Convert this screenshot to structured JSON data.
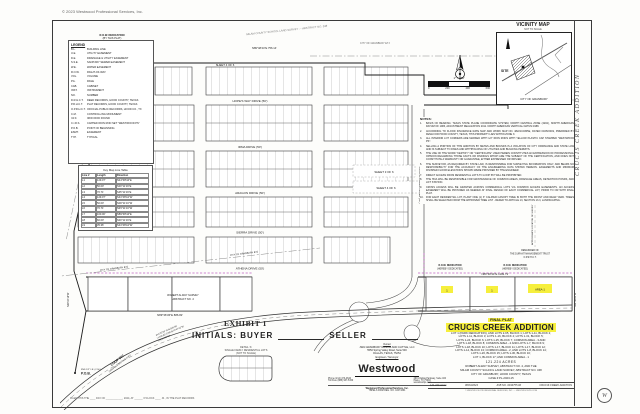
{
  "page": {
    "copyright": "© 2023 Westwood Professional Services, Inc.",
    "side_title": "CRUCIS CREEK ADDITION",
    "filing": "FILED THIS THE ____ DAY OF ____________, 2024, AT ______ O'CLOCK ____ .M., IN THE PLAT RECORDS"
  },
  "exhibit": {
    "label": "EXHIBIT 1",
    "initials": "INITIALS: BUYER",
    "seller": "SELLER"
  },
  "legend": {
    "title": "LEGEND",
    "items": [
      {
        "abbr": "B.L.",
        "desc": "BUILDING LINE"
      },
      {
        "abbr": "U.E.",
        "desc": "UTILITY EASEMENT"
      },
      {
        "abbr": "D.E.",
        "desc": "DRAINAGE & UTILITY EASEMENT"
      },
      {
        "abbr": "S.S.E.",
        "desc": "SANITARY SEWER EASEMENT"
      },
      {
        "abbr": "W.E.",
        "desc": "WATER EASEMENT"
      },
      {
        "abbr": "R.O.W.",
        "desc": "RIGHT-OF-WAY"
      },
      {
        "abbr": "VOL.",
        "desc": "VOLUME"
      },
      {
        "abbr": "PG.",
        "desc": "PAGE"
      },
      {
        "abbr": "CAB.",
        "desc": "CABINET"
      },
      {
        "abbr": "INST.",
        "desc": "INSTRUMENT"
      },
      {
        "abbr": "NO.",
        "desc": "NUMBER"
      },
      {
        "abbr": "D.R.H.C.T.",
        "desc": "DEED RECORDS, HOOD COUNTY, TEXAS"
      },
      {
        "abbr": "P.R.H.C.T.",
        "desc": "PLAT RECORDS, HOOD COUNTY, TEXAS"
      },
      {
        "abbr": "O.P.R.H.C.T.",
        "desc": "OFFICIAL PUBLIC RECORDS, HOOD CO., TX"
      },
      {
        "abbr": "C.M.",
        "desc": "CONTROLLING MONUMENT"
      },
      {
        "abbr": "I.R.F.",
        "desc": "IRON ROD FOUND"
      },
      {
        "abbr": "C.I.R.S.",
        "desc": "CAPPED IRON ROD SET \"WESTWOOD PS\""
      },
      {
        "abbr": "P.O.B.",
        "desc": "POINT OF BEGINNING"
      },
      {
        "abbr": "ESMT.",
        "desc": "EASEMENT"
      },
      {
        "abbr": "TYP.",
        "desc": "TYPICAL"
      }
    ]
  },
  "table": {
    "title": "Key Map Line Table",
    "h_line": "Line #",
    "h_len": "Length",
    "h_dir": "Direction",
    "rows": [
      {
        "id": "L1",
        "len": "129.07'",
        "dir": "N44°48'44\"E"
      },
      {
        "id": "L2",
        "len": "50.00'",
        "dir": "S00°11'16\"E"
      },
      {
        "id": "L3",
        "len": "70.71'",
        "dir": "S45°11'16\"E"
      },
      {
        "id": "L4",
        "len": "129.07'",
        "dir": "S44°48'44\"W"
      },
      {
        "id": "L5",
        "len": "50.00'",
        "dir": "N00°11'16\"W"
      },
      {
        "id": "L6",
        "len": "70.71'",
        "dir": "N45°11'16\"W"
      },
      {
        "id": "L7",
        "len": "100.00'",
        "dir": "N89°48'44\"E"
      },
      {
        "id": "L8",
        "len": "60.00'",
        "dir": "S00°11'16\"E"
      },
      {
        "id": "L9",
        "len": "35.36'",
        "dir": "S44°48'44\"W"
      }
    ]
  },
  "scale": {
    "label": "1\" = 200'",
    "ticks": [
      "0",
      "200",
      "400",
      "600"
    ]
  },
  "vicinity": {
    "title": "VICINITY MAP",
    "nts": "NOT TO SCALE",
    "site": "SITE",
    "city": "CITY OF GRANBURY"
  },
  "plat": {
    "streets": [
      "HOPE'S WAY DRIVE (50')",
      "IRMA DRIVE (50')",
      "ARAGON DRIVE (50')",
      "SIERRA DRIVE (50')",
      "ATHENA DRIVE (50')"
    ],
    "vroad": "CRUCIS CREEK DRIVE (50')",
    "sheets": [
      "SHEET 4 OF 6",
      "SHEET 3 OF 6",
      "SHEET 4 OF 6"
    ],
    "yellow": [
      "1",
      "1",
      "AREA-1"
    ]
  },
  "bearings": {
    "top": "N89°48'44\"E  756.14'",
    "bottom_right": "N89°48'44\"E  1199.79'",
    "bottom_left": "N89°36'36\"E  886.82'",
    "right_vert": "S00°30'29\"W",
    "left_vert": "N00°24'18\"W"
  },
  "surveys": {
    "milam": "MILAM COUNTY SCHOOL LAND SURVEY — ABSTRACT NO. 348",
    "robert1": "ROBERT ALWAY SURVEY",
    "robert2": "ABSTRACT NO. 4",
    "etj": "CITY OF GRANBURY ETJ",
    "remainder1": "REMAINDER OF",
    "remainder2": "THE DURANT MANAGEMENT TRUST",
    "remainder3": "O.P.R.H.C.T.",
    "approx": "APPROXIMATE LOCATION OF SURVEY LINE"
  },
  "row": {
    "a1": "R.O.W. DEDICATION",
    "a2": "(BY THIS PLAT)",
    "b1": "R.O.W. DEDICATION",
    "b2": "(HEREBY DEDICATED)",
    "c1": "R.O.W. DEDICATION",
    "c2": "(HEREBY DEDICATED)"
  },
  "loop": {
    "name": "LOOP 567",
    "sub": "(VARIABLE WIDTH R.O.W.)",
    "c1": "Δ=4°22'06\"  R=5,846.58'",
    "c2": "L=445.80'  CHB=S73°47'42\"W",
    "c3": "CHD=445.69'"
  },
  "pob": {
    "label": "P.O.B.",
    "sub": "FND 1/2\" I.R. (C.M.)"
  },
  "owner": {
    "label": "Owner",
    "name": "JWA GRANBURY RANCH AND CATTLE, LLC",
    "a1": "5550 Spring Valley Road, Suite 500",
    "a2": "DALLAS, TEXAS, 75254",
    "eng_label": "Engineer / Surveyor"
  },
  "ww": {
    "logo": "Westwood",
    "p1": "Phone (214) 473-4640",
    "p2": "Toll Free (888) 937-5150",
    "a1": "2901 Dallas Parkway, Suite 400",
    "a2": "Plano, TX 75093",
    "web": "westwoodps.com",
    "f1": "Westwood Professional Services, Inc.",
    "f2": "TBPELS FIRM REG. NO. 10074301"
  },
  "tb": {
    "fp": "FINAL PLAT",
    "title": "CRUCIS CREEK ADDITION",
    "desc": [
      "LOT 1 (PARK DEDICATION), AND LOTS 2-65, BLOCK 1; LOTS 1-11, BLOCK 2;",
      "LOTS 1-11, BLOCK 3; LOTS 1-16, BLOCK 4; LOTS 1-31, BLOCK 5;",
      "LOTS 1-24, BLOCK 6; LOTS 1-25, BLOCK 7; COMMON AREA - 3 AND",
      "LOTS 1-18, BLOCK 8; COMMON AREA - 4 AND LOTS 1-7, BLOCK 9;",
      "LOTS 1-18, BLOCK 10; LOTS 1-17, BLOCK 11; LOTS 1-17, BLOCK 12;",
      "LOTS 1-14, BLOCK 13; COMMON AREA - 2, AND LOTS 1-8, BLOCK 14;",
      "LOTS 1-26, BLOCK 15; LOTS 1-30, BLOCK 16;",
      "LOT 1, BLOCK 17; AND COMMON AREA - 1"
    ],
    "acres": "121.224 ACRES",
    "s1": "ROBERT ALWAY SURVEY, ABSTRACT NO. 4, AND THE",
    "s2": "MILAM COUNTY SCHOOL LAND SURVEY, ABSTRACT NO. 348",
    "s3": "CITY OF GRANBURY, HOOD COUNTY, TEXAS",
    "case_no": "CASE # PL-2023-15",
    "f_acres": "121.224 Acres",
    "f_date": "08/03/2024",
    "f_job": "JOB NO. 0043755.00",
    "f_name": "CRUCIS CREEK ADDITION",
    "f_copy": "© WESTWOOD PROFESSIONAL SERVICES, INC.  —  WESTWOODPS.COM"
  },
  "notes": {
    "title": "NOTES:",
    "items": [
      {
        "n": "1.",
        "text": "BASIS OF BEARING: TEXAS STATE PLANE COORDINATE SYSTEM, NORTH CENTRAL ZONE (4202), NORTH AMERICAN DATUM OF 1983, ADJUSTMENT REALIZATION 2011. NORTH AMERICAN VERTICAL DATUM 1988."
      },
      {
        "n": "2.",
        "text": "ACCORDING TO FLOOD INSURANCE RATE MAP AND WORK MAP NO. 48221C0305E, DATED 04/05/2019, PREPARED BY FEMA FOR HOOD COUNTY, TEXAS, THIS PROPERTY LIES WITHIN ZONE X."
      },
      {
        "n": "3.",
        "text": "ALL INTERIOR LOT CORNERS ARE MARKED WITH 1/2\" IRON RODS WITH YELLOW PLASTIC CAP STAMPED \"WESTWOOD PS\"."
      },
      {
        "n": "4.",
        "text": "SELLING A PORTION OF THIS ADDITION BY METES AND BOUNDS IS A VIOLATION OF CITY ORDINANCE AND STATE LAW AND IS SUBJECT TO FINES AND WITHHOLDING OF UTILITIES AND BUILDING PERMITS."
      },
      {
        "n": "5.",
        "text": "THE USE OF THE WORD \"CERTIFY\" OR \"CERTIFICATE\" USED HEREIN CONSTITUTES AN EXPRESSION OF PROFESSIONAL OPINION REGARDING THOSE FACTS OR FINDINGS WHICH ARE THE SUBJECT OF THE CERTIFICATION, AND DOES NOT CONSTITUTE A WARRANTY OR GUARANTEE, EITHER EXPRESSED OR IMPLIED."
      },
      {
        "n": "6.",
        "text": "THE SURVEYOR, AS REQUIRED BY STATE LAW, IS RESPONSIBLE FOR SURVEYING INFORMATION ONLY, AND BEARS NO RESPONSIBILITY FOR THE ACCURACY OF THE ENGINEERING DATA SHOWN HEREON. EASEMENTS AND MINIMUM FINISHED FLOOR ELEVATIONS SHOWN WERE PROVIDED BY THE ENGINEER."
      },
      {
        "n": "7.",
        "text": "DIRECT ACCESS FROM RESIDENTIAL LOTS TO LOOP 567 WILL BE PROHIBITED."
      },
      {
        "n": "8.",
        "text": "THE HOA WILL BE RESPONSIBLE FOR MAINTENANCE OF COMMON AREAS, DRAINAGE AREAS, DETENTION PONDS, AND LIFT STATION."
      },
      {
        "n": "9.",
        "text": "CROSS ACCESS WILL BE GRANTED ACROSS COMMERCIAL LOTS VIA COMMON ACCESS EASEMENTS. AN ACCESS EASEMENT WILL BE PROVIDED AS NEEDED AT FINAL DESIGN OF EACH COMMERCIAL LOT, PRIOR TO OR WITH FINAL PLAT."
      },
      {
        "n": "10.",
        "text": "FOR EACH RESIDENTIAL LOT, PLANT ONE (1) 3\" CALIPER CANOPY TREE IN BOTH THE FRONT AND REAR YARD. TREES SHALL BE SELECTED FROM THE APPROVED TREE LIST - REFER TO ARTICLE 13, SECTION 13.3, LANDSCAPING."
      }
    ]
  },
  "inset": {
    "l1": "DETAIL 'A'",
    "l2": "SINGLE FAMILY RESIDENTIAL LOTS",
    "l3": "(NOT TO SCALE)"
  },
  "colors": {
    "highlight": "#f6ef3d",
    "row_magenta": "#c05fc2"
  }
}
